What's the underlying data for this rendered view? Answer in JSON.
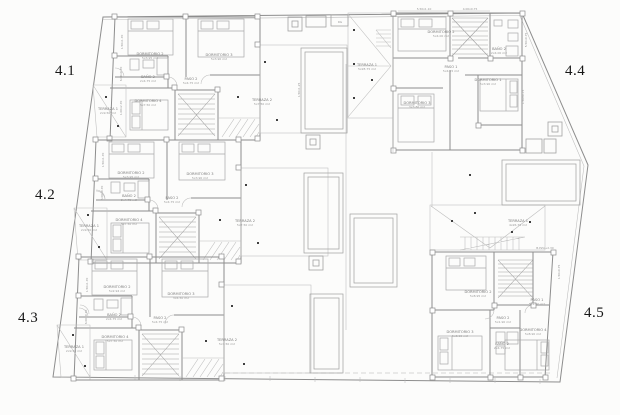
{
  "sheet": {
    "background": "#fcfcfb",
    "wall_color": "#8d8d8d",
    "light_line_color": "#bcbcbc",
    "unit_label_color": "#161616",
    "dot_color": "#3f3f3f"
  },
  "unit_labels": [
    {
      "text": "4.1",
      "x": 55,
      "y": 64
    },
    {
      "text": "4.2",
      "x": 35,
      "y": 188
    },
    {
      "text": "4.3",
      "x": 18,
      "y": 311
    },
    {
      "text": "4.4",
      "x": 565,
      "y": 64
    },
    {
      "text": "4.5",
      "x": 584,
      "y": 306
    }
  ],
  "room_labels": [
    {
      "unit": "4.1",
      "name": "DORMITORIO 2",
      "area": "5x3.95 m2",
      "x": 150,
      "y": 55
    },
    {
      "unit": "4.1",
      "name": "DORMITORIO 3",
      "area": "5x3.90 m2",
      "x": 219,
      "y": 56
    },
    {
      "unit": "4.1",
      "name": "BAÑO 2",
      "area": "2x4.75 m2",
      "x": 148,
      "y": 78
    },
    {
      "unit": "4.1",
      "name": "PASO 2",
      "area": "5x4.75 m2",
      "x": 191,
      "y": 80
    },
    {
      "unit": "4.1",
      "name": "DORMITORIO 4",
      "area": "5x7.50 m2",
      "x": 148,
      "y": 102
    },
    {
      "unit": "4.1",
      "name": "TERRAZA 1",
      "area": "2x9.50 m2",
      "x": 108,
      "y": 110
    },
    {
      "unit": "4.1",
      "name": "TERRAZA 2",
      "area": "5x7.50 m2",
      "x": 262,
      "y": 101
    },
    {
      "unit": "4.2",
      "name": "DORMITORIO 2",
      "area": "5x3.95 m2",
      "x": 131,
      "y": 174
    },
    {
      "unit": "4.2",
      "name": "DORMITORIO 3",
      "area": "5x3.90 m2",
      "x": 200,
      "y": 175
    },
    {
      "unit": "4.2",
      "name": "BAÑO 2",
      "area": "2x4.75 m2",
      "x": 129,
      "y": 197
    },
    {
      "unit": "4.2",
      "name": "PASO 2",
      "area": "5x4.75 m2",
      "x": 172,
      "y": 199
    },
    {
      "unit": "4.2",
      "name": "DORMITORIO 4",
      "area": "5x7.50 m2",
      "x": 129,
      "y": 221
    },
    {
      "unit": "4.2",
      "name": "TERRAZA 1",
      "area": "2x9.50 m2",
      "x": 89,
      "y": 227
    },
    {
      "unit": "4.2",
      "name": "TERRAZA 2",
      "area": "5x7.50 m2",
      "x": 245,
      "y": 222
    },
    {
      "unit": "4.3",
      "name": "DORMITORIO 2",
      "area": "5x2.94 m2",
      "x": 117,
      "y": 288
    },
    {
      "unit": "4.3",
      "name": "DORMITORIO 3",
      "area": "3x4.50 m2",
      "x": 181,
      "y": 295
    },
    {
      "unit": "4.3",
      "name": "BAÑO 2",
      "area": "2x4.75 m2",
      "x": 114,
      "y": 316
    },
    {
      "unit": "4.3",
      "name": "PASO 2",
      "area": "5x4.75 m2",
      "x": 160,
      "y": 319
    },
    {
      "unit": "4.3",
      "name": "DORMITORIO 4",
      "area": "5x7.50 m2",
      "x": 115,
      "y": 338
    },
    {
      "unit": "4.3",
      "name": "TERRAZA 1",
      "area": "2x9.50 m2",
      "x": 74,
      "y": 348
    },
    {
      "unit": "4.3",
      "name": "TERRAZA 2",
      "area": "5x7.50 m2",
      "x": 227,
      "y": 341
    },
    {
      "unit": "4.4",
      "name": "DORMITORIO 2",
      "area": "5x4.00 m2",
      "x": 441,
      "y": 33
    },
    {
      "unit": "4.4",
      "name": "BAÑO 2",
      "area": "2x4.00 m2",
      "x": 499,
      "y": 50
    },
    {
      "unit": "4.4",
      "name": "PASO 1",
      "area": "5x4.15 m2",
      "x": 451,
      "y": 68
    },
    {
      "unit": "4.4",
      "name": "DORMITORIO 1",
      "area": "5x3.90 m2",
      "x": 488,
      "y": 81
    },
    {
      "unit": "4.4",
      "name": "DORMITORIO 3",
      "area": "3x3.80 m2",
      "x": 417,
      "y": 104
    },
    {
      "unit": "4.4",
      "name": "TERRAZA 1",
      "area": "5x28.75 m2",
      "x": 367,
      "y": 66
    },
    {
      "unit": "4.5",
      "name": "TERRAZA 1",
      "area": "4x26.75 m2",
      "x": 518,
      "y": 222
    },
    {
      "unit": "4.5",
      "name": "PASO 1",
      "area": "5x1.90 m2",
      "x": 537,
      "y": 301
    },
    {
      "unit": "4.5",
      "name": "DORMITORIO 2",
      "area": "5x8.95 m2",
      "x": 478,
      "y": 293
    },
    {
      "unit": "4.5",
      "name": "PASO 2",
      "area": "5x1.90 m2",
      "x": 503,
      "y": 319
    },
    {
      "unit": "4.5",
      "name": "DORMITORIO 3",
      "area": "5x8.90 m2",
      "x": 460,
      "y": 333
    },
    {
      "unit": "4.5",
      "name": "DORMITORIO 4",
      "area": "5x8.90 m2",
      "x": 533,
      "y": 331
    },
    {
      "unit": "4.5",
      "name": "BAÑO 2",
      "area": "2x4.75 m2",
      "x": 502,
      "y": 345
    }
  ],
  "dim_labels": [
    {
      "t": "5.50x1.10",
      "x": 424,
      "y": 10,
      "r": 0
    },
    {
      "t": "4.00x0.75",
      "x": 470,
      "y": 10,
      "r": 0
    },
    {
      "t": "RG",
      "x": 340,
      "y": 23,
      "r": 0
    },
    {
      "t": "1.50x1.70",
      "x": 123,
      "y": 42,
      "r": -90
    },
    {
      "t": "6.00x0.70",
      "x": 122,
      "y": 74,
      "r": -90
    },
    {
      "t": "1.00x2.70",
      "x": 122,
      "y": 108,
      "r": -90
    },
    {
      "t": "1.50x1.70",
      "x": 104,
      "y": 160,
      "r": -90
    },
    {
      "t": "6.00x0.70",
      "x": 103,
      "y": 193,
      "r": -90
    },
    {
      "t": "1.50x1.70",
      "x": 88,
      "y": 285,
      "r": -90
    },
    {
      "t": "6.00x0.70",
      "x": 87,
      "y": 317,
      "r": -90
    },
    {
      "t": "5.50x0.75",
      "x": 527,
      "y": 40,
      "r": -90
    },
    {
      "t": "1.50x0.75",
      "x": 524,
      "y": 97,
      "r": -90
    },
    {
      "t": "1.50x1.25",
      "x": 300,
      "y": 90,
      "r": -90
    },
    {
      "t": "B.PZA+2.30",
      "x": 545,
      "y": 249,
      "r": 0
    },
    {
      "t": "1.50x0.75",
      "x": 560,
      "y": 272,
      "r": -90
    }
  ],
  "dots": [
    [
      106,
      97
    ],
    [
      118,
      126
    ],
    [
      238,
      97
    ],
    [
      265,
      62
    ],
    [
      277,
      120
    ],
    [
      88,
      215
    ],
    [
      99,
      247
    ],
    [
      246,
      185
    ],
    [
      220,
      220
    ],
    [
      258,
      243
    ],
    [
      73,
      335
    ],
    [
      85,
      366
    ],
    [
      232,
      306
    ],
    [
      206,
      341
    ],
    [
      244,
      364
    ],
    [
      354,
      30
    ],
    [
      354,
      64
    ],
    [
      354,
      98
    ],
    [
      372,
      80
    ],
    [
      452,
      221
    ],
    [
      475,
      213
    ],
    [
      512,
      232
    ],
    [
      530,
      222
    ],
    [
      470,
      175
    ]
  ]
}
